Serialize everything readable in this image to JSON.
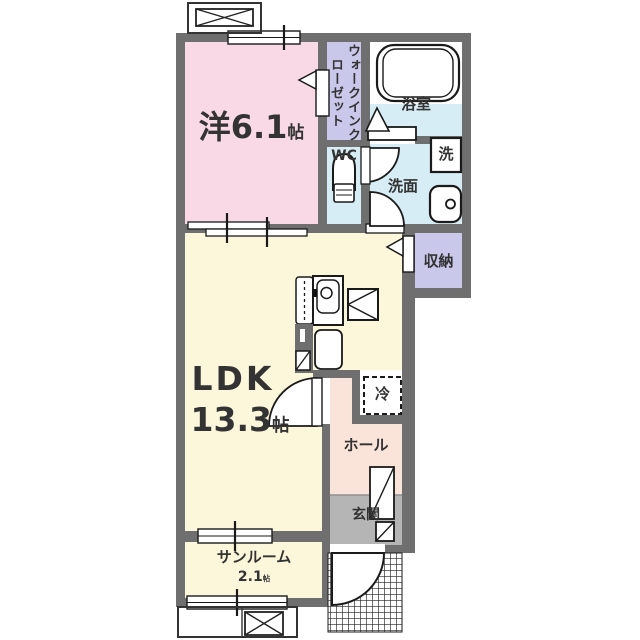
{
  "colors": {
    "wall": "#6f6f6f",
    "western": "#f8d9e5",
    "closet": "#c9c8ea",
    "water": "#d6edf6",
    "ldk": "#fcf6da",
    "hall": "#fae3d8",
    "entrance_floor": "#b5b5b5",
    "text": "#333333"
  },
  "rooms": {
    "western": {
      "name": "洋",
      "area": "6.1",
      "unit": "帖"
    },
    "walk_in_closet": {
      "name": "ウォークインクローゼット"
    },
    "bathroom": {
      "name": "浴室"
    },
    "wc": {
      "name": "WC"
    },
    "washroom": {
      "name": "洗面"
    },
    "washing_machine": {
      "name": "洗"
    },
    "storage": {
      "name": "収納"
    },
    "ldk": {
      "name": "LDK",
      "area": "13.3",
      "unit": "帖"
    },
    "refrigerator": {
      "name": "冷"
    },
    "hall": {
      "name": "ホール"
    },
    "entrance": {
      "name": "玄関"
    },
    "sunroom": {
      "name": "サンルーム",
      "area": "2.1",
      "unit": "帖"
    }
  }
}
